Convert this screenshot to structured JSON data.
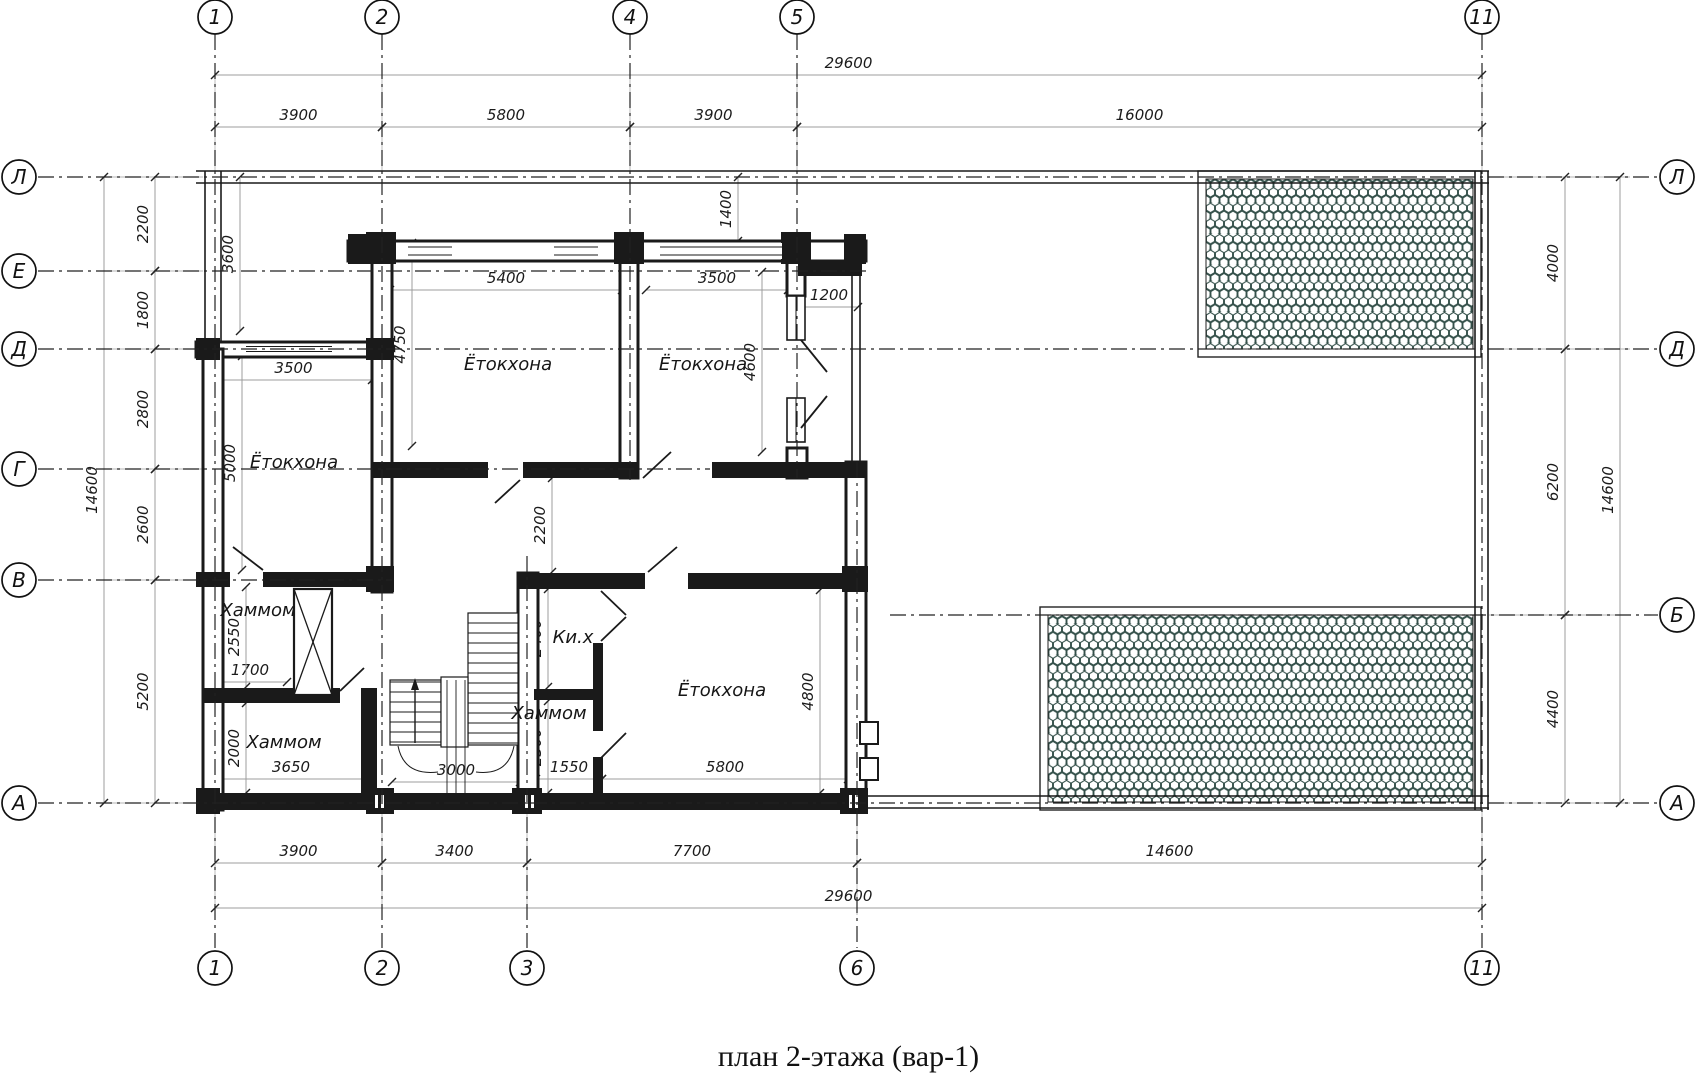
{
  "title": "план 2-этажа (вар-1)",
  "colors": {
    "line": "#1a1a1a",
    "dim_line": "#9c9c9c",
    "ext_line": "#b5b5b5",
    "hatch": "#34504a",
    "tick": "#222222"
  },
  "axes": {
    "top": [
      {
        "label": "1",
        "x": 215
      },
      {
        "label": "2",
        "x": 382
      },
      {
        "label": "4",
        "x": 630
      },
      {
        "label": "5",
        "x": 797
      },
      {
        "label": "11",
        "x": 1482
      }
    ],
    "bottom": [
      {
        "label": "1",
        "x": 215
      },
      {
        "label": "2",
        "x": 382
      },
      {
        "label": "3",
        "x": 527
      },
      {
        "label": "6",
        "x": 857
      },
      {
        "label": "11",
        "x": 1482
      }
    ],
    "left": [
      {
        "label": "Л",
        "y": 177
      },
      {
        "label": "Е",
        "y": 271
      },
      {
        "label": "Д",
        "y": 349
      },
      {
        "label": "Г",
        "y": 469
      },
      {
        "label": "В",
        "y": 580
      },
      {
        "label": "А",
        "y": 803
      }
    ],
    "right": [
      {
        "label": "Л",
        "y": 177
      },
      {
        "label": "Д",
        "y": 349
      },
      {
        "label": "Б",
        "y": 615
      },
      {
        "label": "А",
        "y": 803
      }
    ]
  },
  "dims": {
    "top": [
      {
        "v": "29600",
        "a": 215,
        "b": 1482,
        "c": 75
      },
      {
        "v": "3900",
        "a": 215,
        "b": 382,
        "c": 127
      },
      {
        "v": "5800",
        "a": 382,
        "b": 630,
        "c": 127
      },
      {
        "v": "3900",
        "a": 630,
        "b": 797,
        "c": 127
      },
      {
        "v": "16000",
        "a": 797,
        "b": 1482,
        "c": 127
      }
    ],
    "bottom": [
      {
        "v": "3900",
        "a": 215,
        "b": 382,
        "c": 863
      },
      {
        "v": "3400",
        "a": 382,
        "b": 527,
        "c": 863
      },
      {
        "v": "7700",
        "a": 527,
        "b": 857,
        "c": 863
      },
      {
        "v": "14600",
        "a": 857,
        "b": 1482,
        "c": 863
      },
      {
        "v": "29600",
        "a": 215,
        "b": 1482,
        "c": 908
      }
    ],
    "left": [
      {
        "v": "2200",
        "a": 177,
        "b": 271,
        "c": 155
      },
      {
        "v": "1800",
        "a": 271,
        "b": 349,
        "c": 155
      },
      {
        "v": "2800",
        "a": 349,
        "b": 469,
        "c": 155
      },
      {
        "v": "2600",
        "a": 469,
        "b": 580,
        "c": 155
      },
      {
        "v": "5200",
        "a": 580,
        "b": 803,
        "c": 155
      },
      {
        "v": "14600",
        "a": 177,
        "b": 803,
        "c": 104
      }
    ],
    "right": [
      {
        "v": "4000",
        "a": 177,
        "b": 349,
        "c": 1565
      },
      {
        "v": "6200",
        "a": 349,
        "b": 615,
        "c": 1565
      },
      {
        "v": "4400",
        "a": 615,
        "b": 803,
        "c": 1565
      },
      {
        "v": "14600",
        "a": 177,
        "b": 803,
        "c": 1620
      }
    ],
    "inner_h": [
      {
        "v": "5400",
        "a": 390,
        "b": 622,
        "c": 290
      },
      {
        "v": "3500",
        "a": 646,
        "b": 788,
        "c": 290
      },
      {
        "v": "1200",
        "a": 800,
        "b": 858,
        "c": 307
      },
      {
        "v": "3500",
        "a": 215,
        "b": 372,
        "c": 380
      },
      {
        "v": "1700",
        "a": 213,
        "b": 287,
        "c": 682
      },
      {
        "v": "3650",
        "a": 213,
        "b": 369,
        "c": 779
      },
      {
        "v": "3000",
        "a": 392,
        "b": 520,
        "c": 782
      },
      {
        "v": "1550",
        "a": 536,
        "b": 602,
        "c": 779
      },
      {
        "v": "5800",
        "a": 602,
        "b": 848,
        "c": 779
      }
    ],
    "inner_v": [
      {
        "v": "3600",
        "a": 177,
        "b": 331,
        "c": 240
      },
      {
        "v": "1400",
        "a": 177,
        "b": 241,
        "c": 738
      },
      {
        "v": "4750",
        "a": 243,
        "b": 446,
        "c": 412
      },
      {
        "v": "4600",
        "a": 272,
        "b": 452,
        "c": 762
      },
      {
        "v": "5000",
        "a": 356,
        "b": 570,
        "c": 242
      },
      {
        "v": "2200",
        "a": 478,
        "b": 572,
        "c": 552
      },
      {
        "v": "2550",
        "a": 587,
        "b": 687,
        "c": 246
      },
      {
        "v": "2000",
        "a": 703,
        "b": 793,
        "c": 246
      },
      {
        "v": "2400",
        "a": 589,
        "b": 687,
        "c": 548
      },
      {
        "v": "2300",
        "a": 701,
        "b": 793,
        "c": 548
      },
      {
        "v": "4800",
        "a": 590,
        "b": 793,
        "c": 820
      }
    ]
  },
  "rooms": [
    {
      "name": "Ётокхона",
      "x": 508,
      "y": 364
    },
    {
      "name": "Ётокхона",
      "x": 703,
      "y": 364
    },
    {
      "name": "Ётокхона",
      "x": 294,
      "y": 462
    },
    {
      "name": "Ётокхона",
      "x": 722,
      "y": 690
    },
    {
      "name": "Хаммом",
      "x": 258,
      "y": 610
    },
    {
      "name": "Хаммом",
      "x": 284,
      "y": 742
    },
    {
      "name": "Хаммом",
      "x": 549,
      "y": 713
    },
    {
      "name": "Ки.х",
      "x": 573,
      "y": 637
    }
  ]
}
